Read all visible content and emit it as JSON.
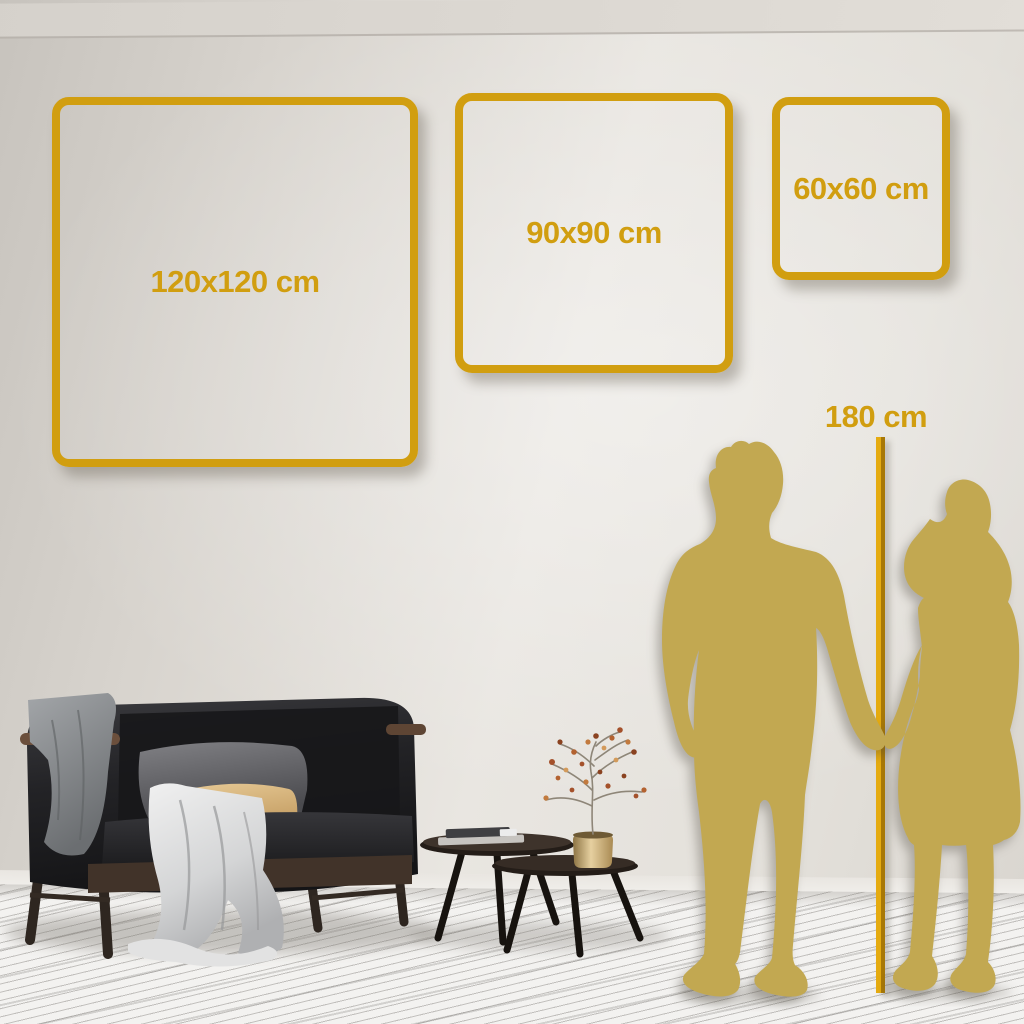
{
  "size_guide": {
    "frames": [
      {
        "label": "120x120 cm",
        "size_cm": "120x120"
      },
      {
        "label": "90x90 cm",
        "size_cm": "90x90"
      },
      {
        "label": "60x60 cm",
        "size_cm": "60x60"
      }
    ],
    "height_reference": {
      "label": "180 cm",
      "value_cm": 180
    }
  },
  "colors": {
    "accent_gold": "#D19E10",
    "silhouette_gold": "#C2A851",
    "wall": "#E4E1DB",
    "floor": "#F3F2F0",
    "sofa": "#232326",
    "beige_pillow": "#D9B87F",
    "vase_brass": "#C9A566"
  },
  "scene_objects": {
    "left": [
      "sofa",
      "gray-throw-blanket",
      "white-throw-blanket",
      "gray-pillow",
      "beige-lumbar-pillow"
    ],
    "center": [
      "nesting-coffee-tables",
      "book-stack",
      "brass-vase",
      "dried-branch-plant"
    ],
    "right": [
      "man-silhouette",
      "woman-silhouette",
      "height-ruler-line"
    ]
  }
}
